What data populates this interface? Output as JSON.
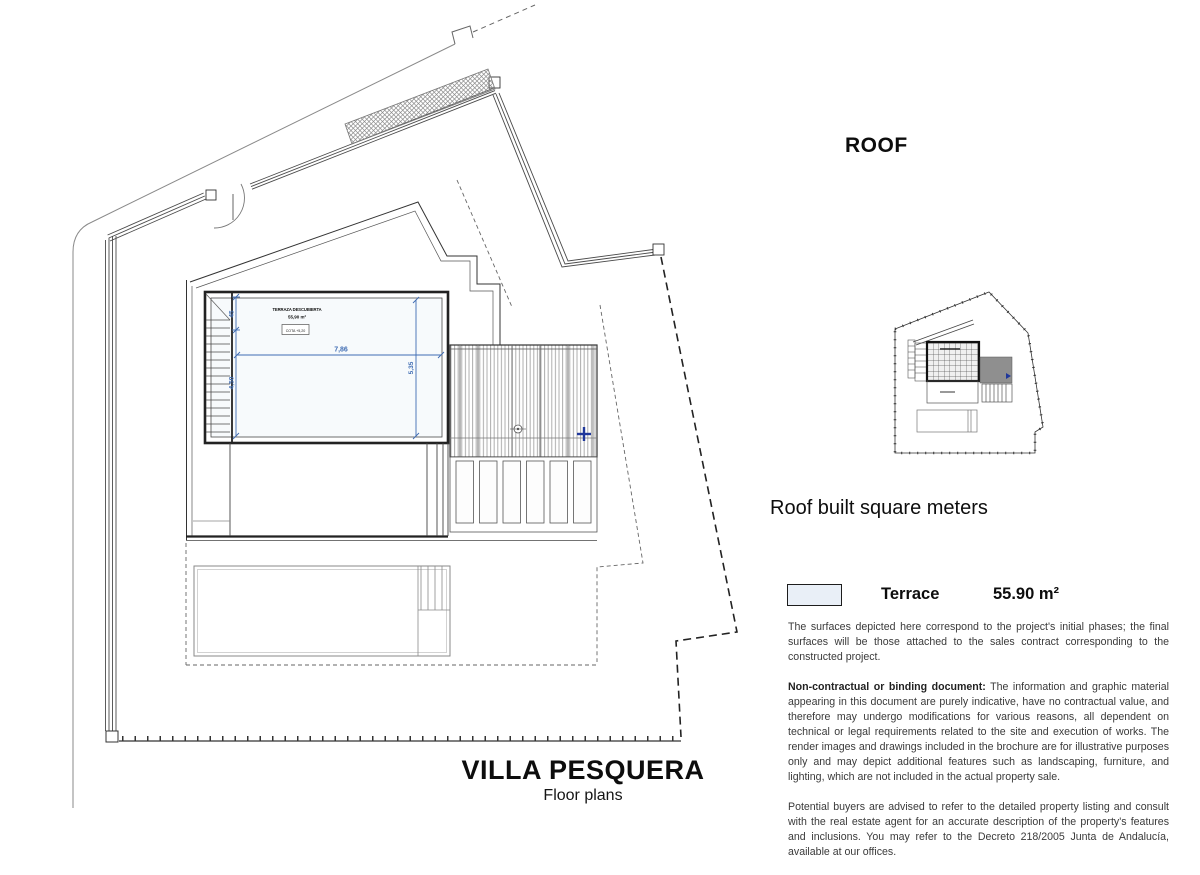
{
  "header": {
    "roof_label": "ROOF"
  },
  "plan": {
    "dimensions": {
      "width_label": "7,86",
      "left_upper_label": "45",
      "left_lower_label": "4,50",
      "right_label": "5,35"
    },
    "room": {
      "name": "TERRAZA DESCUBIERTA",
      "area": "55,90 m²",
      "cota": "COTA +5,20"
    },
    "colors": {
      "dimension_blue": "#3f6cb3",
      "marker_blue": "#20389b",
      "line_dark": "#2b2b2b",
      "hatch_gray": "#8c8c8c"
    }
  },
  "summary": {
    "title": "Roof built square meters",
    "legend": [
      {
        "swatch_color": "#e9eff7",
        "label": "Terrace",
        "value": "55.90 m²"
      }
    ]
  },
  "disclaimer": {
    "p1": "The surfaces depicted here correspond to the project's initial phases; the final surfaces will be those attached to the sales contract corresponding to the constructed project.",
    "p2_bold": "Non-contractual or binding document:",
    "p2_rest": " The information and graphic material appearing in this document are purely indicative, have no contractual value, and therefore may undergo modifications for various reasons, all dependent on technical or legal requirements related to the site and execution of works. The render images and drawings included in the brochure are for illustrative purposes only and may depict additional features such as landscaping, furniture, and lighting, which are not included in the actual property sale.",
    "p3": "Potential buyers are advised to refer to the detailed property listing and consult with the real estate agent for an accurate description of the property's features and inclusions. You may refer to the Decreto 218/2005 Junta de Andalucía, available at our offices."
  },
  "footer": {
    "title": "VILLA PESQUERA",
    "subtitle": "Floor plans"
  }
}
